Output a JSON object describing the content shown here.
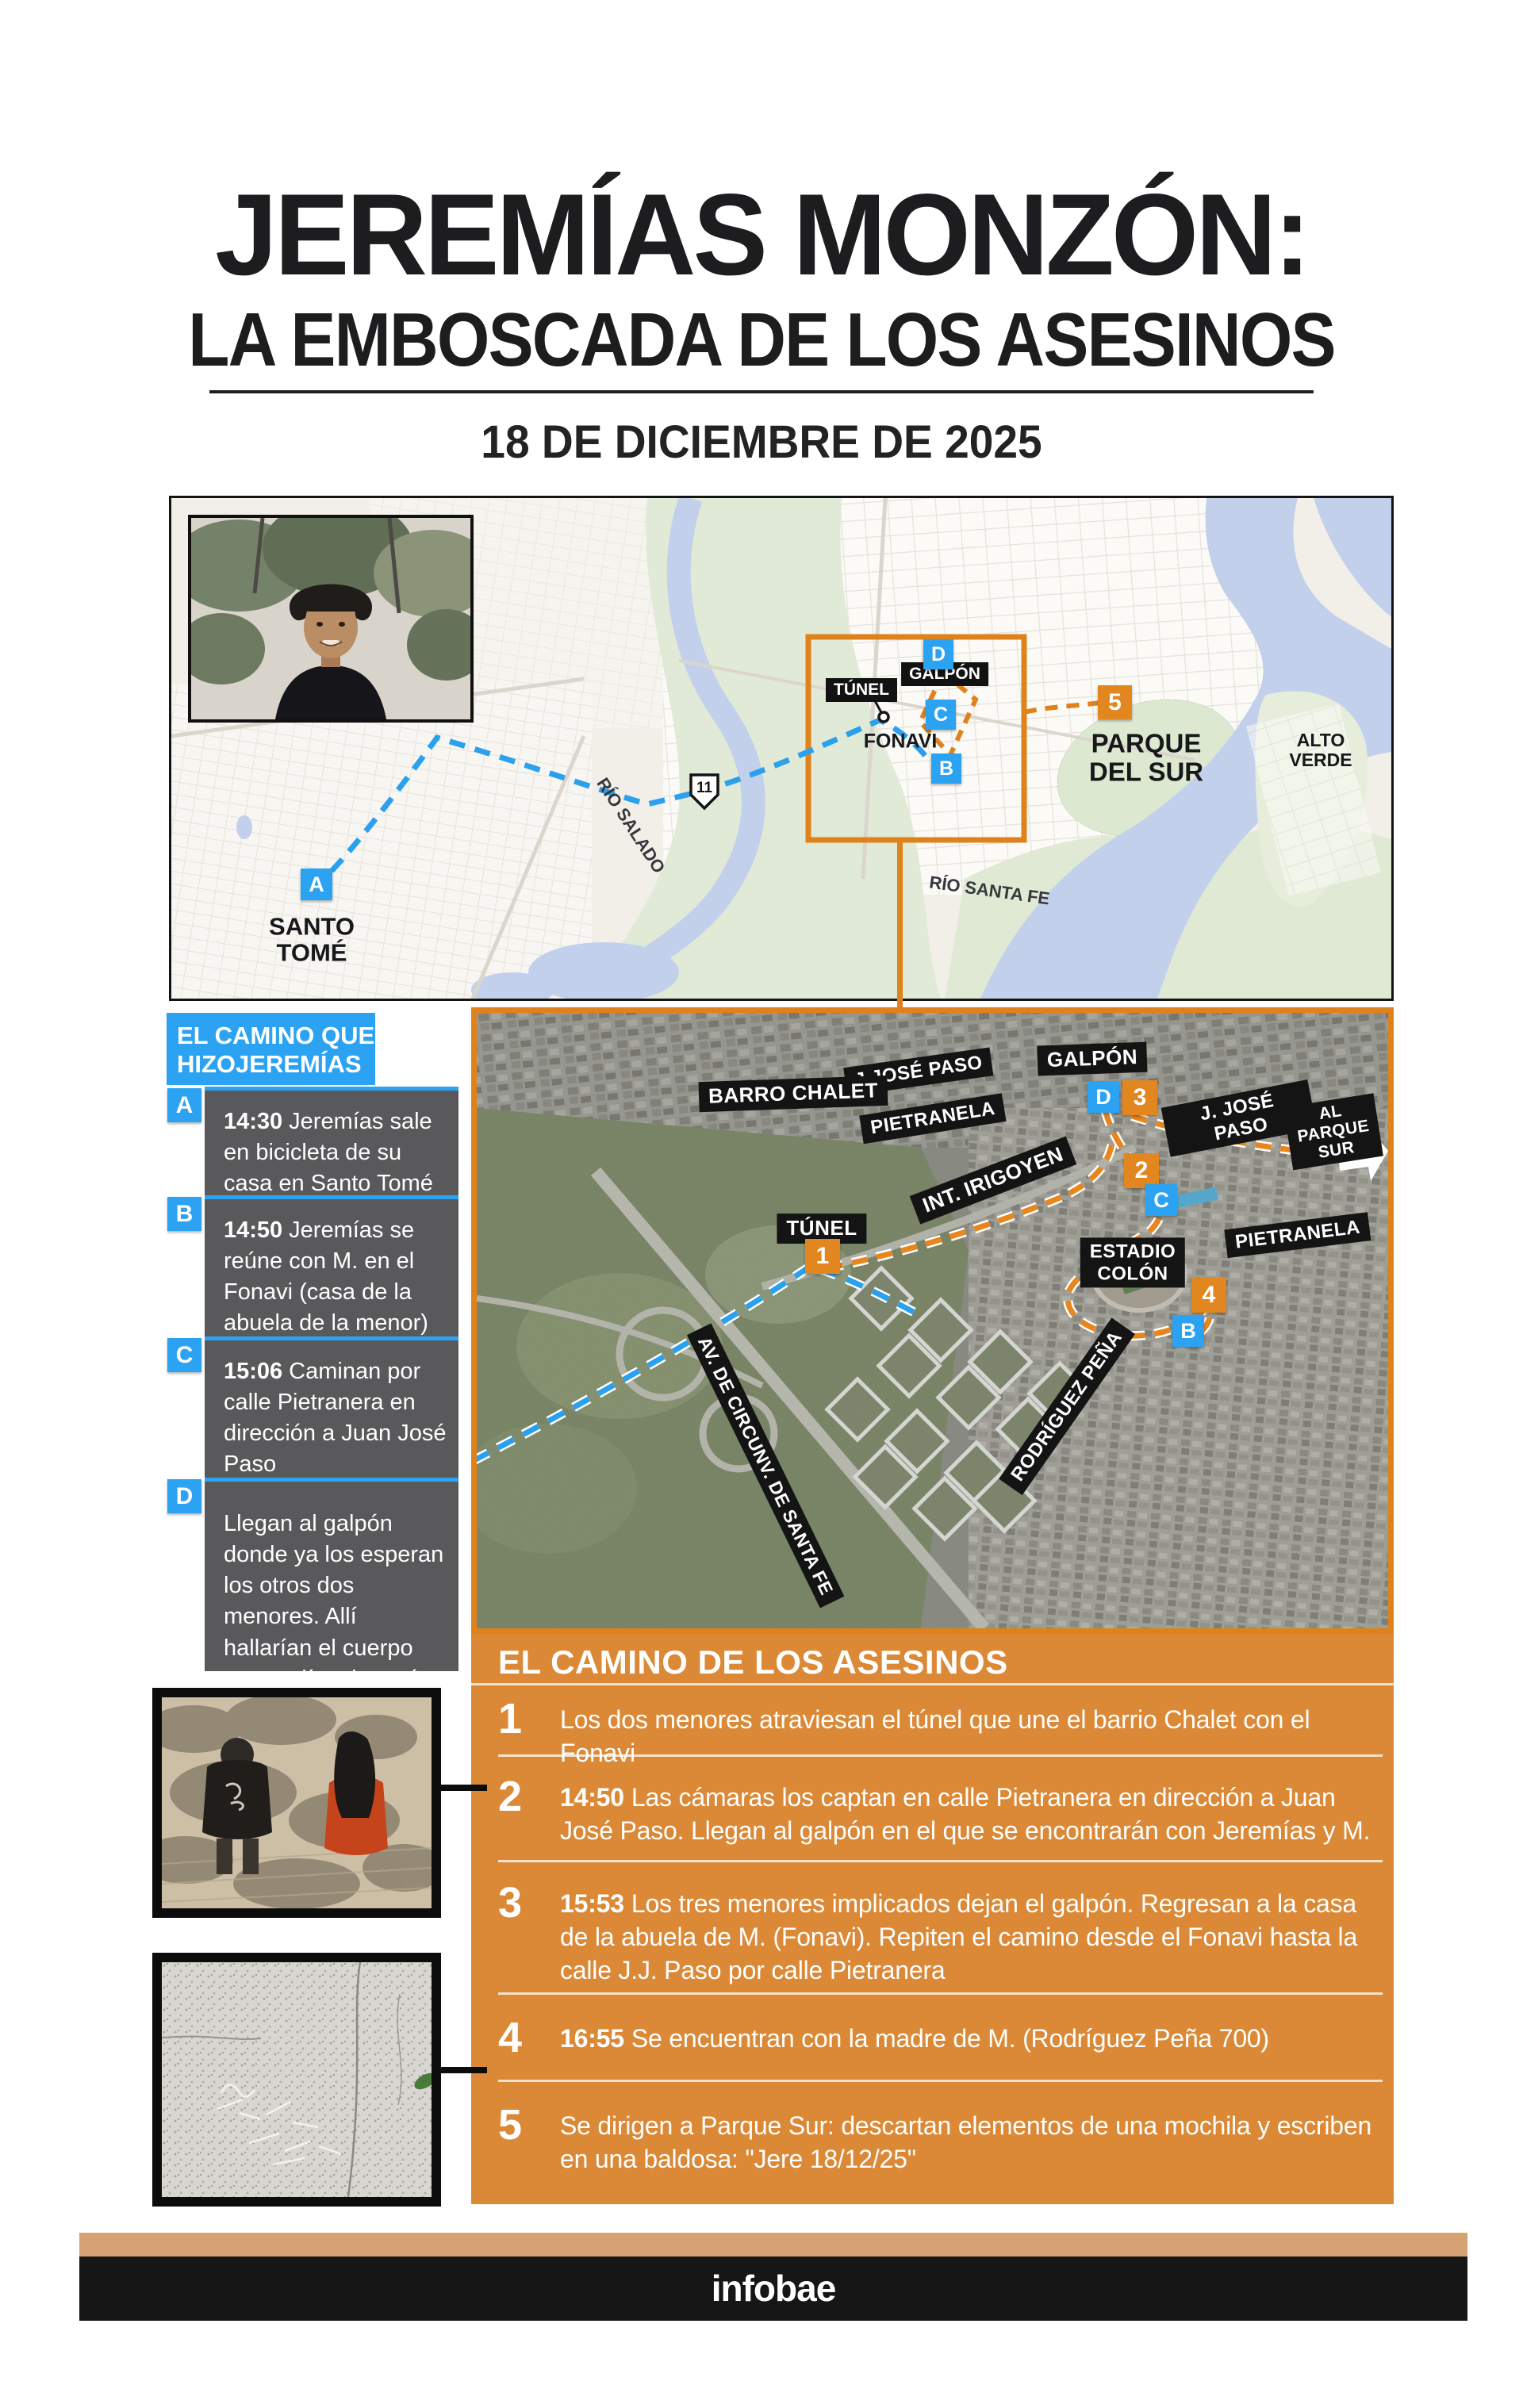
{
  "colors": {
    "accent_blue": "#2CA3F2",
    "panel_orange": "#DB8936",
    "marker_orange": "#E2861F",
    "map_frame_orange": "#E0821C",
    "footer_tan": "#D7A273",
    "footer_black": "#161616"
  },
  "title": {
    "line1": "JEREMÍAS MONZÓN:",
    "line2": "LA EMBOSCADA DE LOS ASESINOS",
    "date": "18 DE DICIEMBRE DE 2025"
  },
  "street_map": {
    "labels": {
      "santo_tome": "SANTO\nTOMÉ",
      "rio_salado": "RÍO SALADO",
      "rio_santa_fe": "RÍO SANTA FE",
      "alto_verde": "ALTO\nVERDE",
      "parque_del_sur": "PARQUE\nDEL SUR",
      "tunel": "TÚNEL",
      "galpon": "GALPÓN",
      "fonavi": "FONAVI",
      "route11": "11"
    },
    "markers": {
      "a": "A",
      "b": "B",
      "c": "C",
      "d": "D",
      "n5": "5"
    }
  },
  "sidebar": {
    "header_line1": "EL CAMINO QUE",
    "header_line2": "HIZOJEREMÍAS",
    "items": [
      {
        "letter": "A",
        "time": "14:30",
        "text": "Jeremías sale en bicicleta de su casa en Santo Tomé"
      },
      {
        "letter": "B",
        "time": "14:50",
        "text": "Jeremías se reúne con M. en el Fonavi (casa de la abuela de la menor)"
      },
      {
        "letter": "C",
        "time": "15:06",
        "text": "Caminan por calle Pietranera en dirección a Juan José Paso"
      },
      {
        "letter": "D",
        "time": "",
        "text": "Llegan al galpón donde ya los esperan los otros dos menores. Allí hallarían el cuerpo cuatro días después"
      }
    ]
  },
  "satellite_map": {
    "labels": {
      "barrio_chalet": "BARRO CHALET",
      "jjose_paso_top": "J.JOSÉ PASO",
      "pietranela_top": "PIETRANELA",
      "galpon": "GALPÓN",
      "jjose_paso_right": "J. JOSÉ PASO",
      "al_parque_sur": "AL PARQUE SUR",
      "int_irigoyen": "INT. IRIGOYEN",
      "tunel": "TÚNEL",
      "estadio_colon": "ESTADIO\nCOLÓN",
      "pietranela_right": "PIETRANELA",
      "rodriguez_pena": "RODRÍGUEZ PEÑA",
      "av_circunv": "AV. DE CIRCUNV. DE SANTA FE"
    },
    "markers": {
      "n1": "1",
      "n2": "2",
      "n3": "3",
      "n4": "4",
      "b": "B",
      "c": "C",
      "d": "D"
    }
  },
  "killers_panel": {
    "header": "EL CAMINO DE LOS ASESINOS",
    "items": [
      {
        "num": "1",
        "time": "",
        "text": "Los dos menores atraviesan el túnel que une el barrio Chalet con el Fonavi"
      },
      {
        "num": "2",
        "time": "14:50",
        "text": "Las cámaras los captan en calle Pietranera en dirección a Juan José Paso. Llegan al galpón en el que se encontrarán con Jeremías y M."
      },
      {
        "num": "3",
        "time": "15:53",
        "text": "Los tres menores implicados dejan el galpón. Regresan a la casa de la abuela de M. (Fonavi). Repiten el camino desde el Fonavi hasta la calle J.J. Paso por calle Pietranera"
      },
      {
        "num": "4",
        "time": "16:55",
        "text": "Se encuentran con la madre de M. (Rodríguez Peña 700)"
      },
      {
        "num": "5",
        "time": "",
        "text": "Se dirigen a Parque Sur: descartan elementos de una mochila y escriben en una baldosa: \"Jere 18/12/25\""
      }
    ]
  },
  "footer": {
    "brand": "infobae"
  }
}
